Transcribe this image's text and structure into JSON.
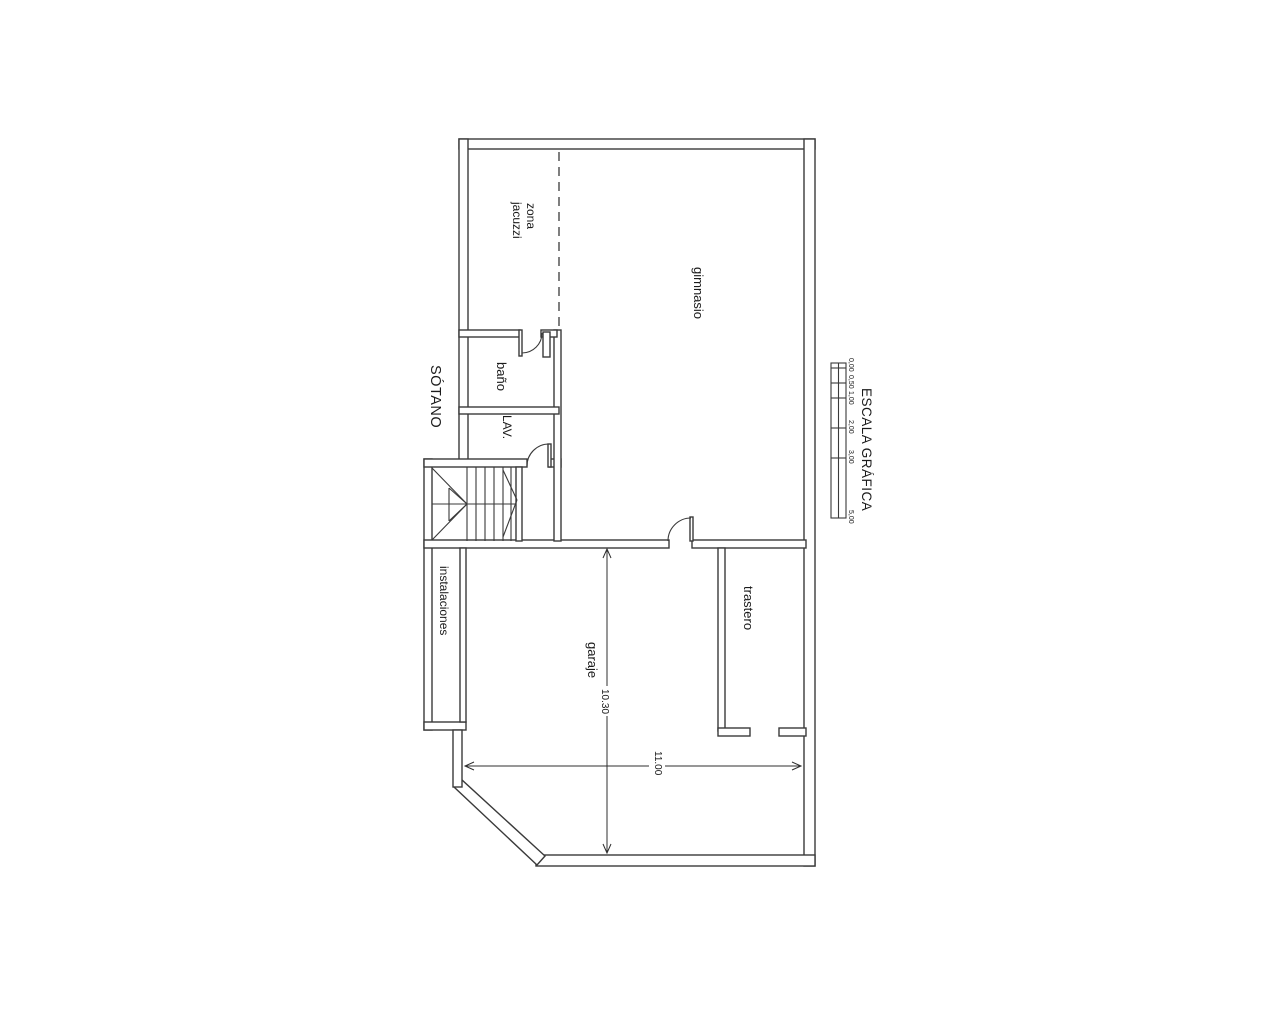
{
  "page": {
    "background_color": "#ffffff",
    "line_color": "#3a3a3a",
    "text_color": "#1b1b1b"
  },
  "plan": {
    "title": "SÓTANO",
    "rooms": {
      "zona_jacuzzi_line1": "zona",
      "zona_jacuzzi_line2": "jacuzzi",
      "gimnasio": "gimnasio",
      "bano": "baño",
      "lavadero": "LAV.",
      "instalaciones": "instalaciones",
      "garaje": "garaje",
      "trastero": "trastero"
    },
    "dimensions": {
      "garaje_length": "10.30",
      "garaje_width": "11.00"
    },
    "scale_bar": {
      "title": "ESCALA GRÁFICA",
      "ticks": [
        "0,00",
        "0,50",
        "1,00",
        "2,00",
        "3,00",
        "5,00"
      ]
    }
  }
}
